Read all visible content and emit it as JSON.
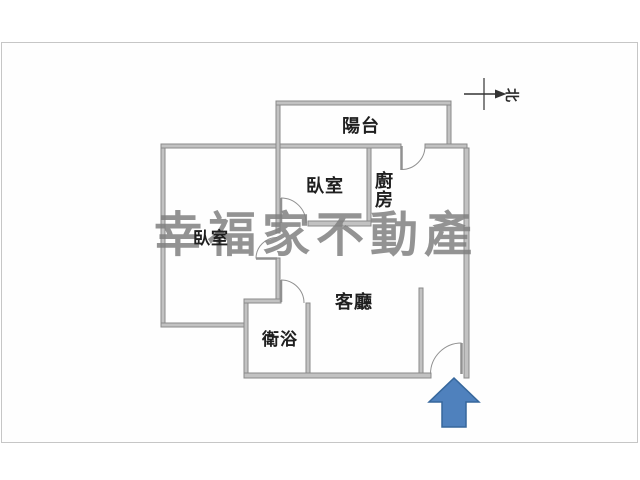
{
  "rooms": {
    "balcony": "陽台",
    "bedroom_main": "臥室",
    "kitchen": "廚房",
    "bedroom_left": "臥室",
    "living_room": "客廳",
    "bathroom": "衛浴"
  },
  "compass": {
    "north": "北"
  },
  "watermark": "幸福家不動產",
  "colors": {
    "wall_fill": "#c2c2c2",
    "wall_edge": "#8a8a8a",
    "door_line": "#909090",
    "frame_border": "#c6c6c6",
    "label_text": "#1f1f1f",
    "watermark_gray": "#808080",
    "entrance_arrow_fill": "#4f81bd",
    "entrance_arrow_outline": "#36679c"
  }
}
